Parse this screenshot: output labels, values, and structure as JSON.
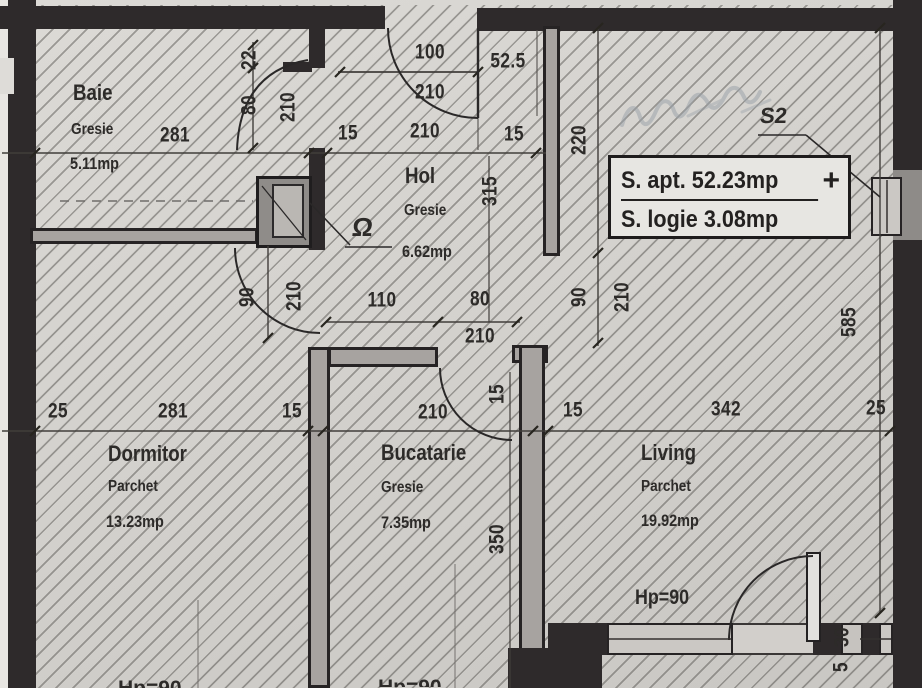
{
  "title": "Apartment floor plan",
  "colors": {
    "wall": "#2e2a2b",
    "paper": "#d5d3cf",
    "ink": "#2f2d2b",
    "window_fill": "#cbc8c4"
  },
  "rooms": {
    "baie": {
      "name": "Baie",
      "finish": "Gresie",
      "area": "5.11mp"
    },
    "hol": {
      "name": "Hol",
      "finish": "Gresie",
      "area": "6.62mp"
    },
    "dormitor": {
      "name": "Dormitor",
      "finish": "Parchet",
      "area": "13.23mp"
    },
    "bucatarie": {
      "name": "Bucatarie",
      "finish": "Gresie",
      "area": "7.35mp"
    },
    "living": {
      "name": "Living",
      "finish": "Parchet",
      "area": "19.92mp"
    }
  },
  "info_box": {
    "apt_label": "S. apt. 52.23mp",
    "plus": "+",
    "logie_label": "S. logie 3.08mp"
  },
  "annotations": {
    "window_mark": "S2",
    "shaft_mark": "Ω",
    "parapet": "Hp=90",
    "parapet_left": "Hp=90",
    "parapet_mid": "Hp=90"
  },
  "dims": {
    "entrance_width": "100",
    "entrance_height": "210",
    "niche": "52.5",
    "baie_width": "281",
    "wall_top_left": "15",
    "hol_width": "210",
    "wall_top_right": "15",
    "baie_door_offset": "22",
    "baie_door_width": "80",
    "baie_door_height": "210",
    "hol_wall": "220",
    "hol_length": "315",
    "dorm_door_width": "90",
    "dorm_door_height": "210",
    "hol_door_width": "90",
    "hol_door_height": "210",
    "kitchen_door_offset": "110",
    "kitchen_door_width": "80",
    "kitchen_door_height": "210",
    "kitchen_jamb": "15",
    "kitchen_length": "350",
    "row_wall_left": "25",
    "row_dorm": "281",
    "row_wall_a": "15",
    "row_kitchen": "210",
    "row_wall_b": "15",
    "row_living": "342",
    "row_wall_right": "25",
    "living_length": "585",
    "balcony_wall": "30",
    "balcony_gap": "5"
  }
}
